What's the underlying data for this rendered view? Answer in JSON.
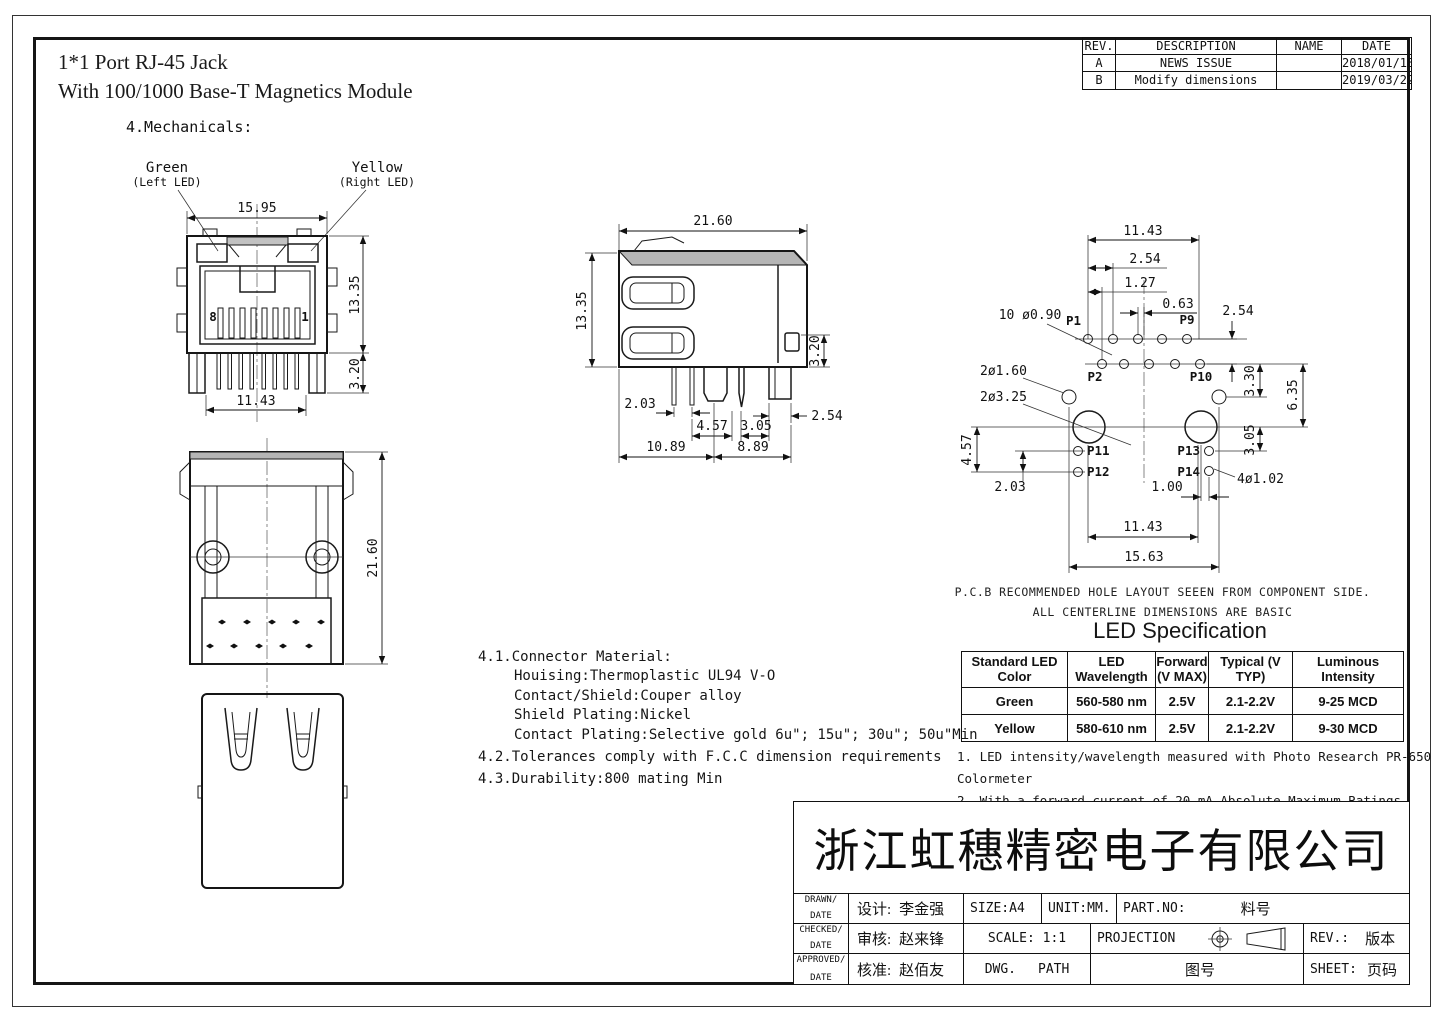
{
  "page": {
    "title_line1": "1*1 Port RJ-45  Jack",
    "title_line2": "With 100/1000 Base-T Magnetics Module"
  },
  "revision_table": {
    "headers": {
      "rev": "REV.",
      "description": "DESCRIPTION",
      "name": "NAME",
      "date": "DATE"
    },
    "rows": [
      {
        "rev": "A",
        "description": "NEWS ISSUE",
        "name": "",
        "date": "2018/01/18"
      },
      {
        "rev": "B",
        "description": "Modify dimensions",
        "name": "",
        "date": "2019/03/22"
      }
    ]
  },
  "mechanical": {
    "heading": "4.Mechanicals:",
    "led_left_label": "Green",
    "led_left_sub": "(Left LED)",
    "led_right_label": "Yellow",
    "led_right_sub": "(Right LED)"
  },
  "front_view": {
    "dim_width_top": "15.95",
    "dim_height_right": "13.35",
    "dim_pins_bottom": "11.43",
    "dim_leg_height": "3.20",
    "contact_num_left": "8",
    "contact_num_right": "1"
  },
  "side_view": {
    "dim_depth_top": "21.60",
    "dim_height_left": "13.35",
    "dim_tab_right": "3.20",
    "dim_pin_pitch": "2.03",
    "dim_pin_span": "4.57",
    "dim_post_gap": "3.05",
    "dim_block_width": "2.54",
    "dim_base_left": "10.89",
    "dim_base_right": "8.89"
  },
  "top_view": {
    "dim_length": "21.60"
  },
  "pcb_layout": {
    "dim_top_span": "11.43",
    "dim_pitch": "2.54",
    "dim_row_offset": "1.27",
    "dim_half_offset": "0.63",
    "dim_row_gap": "2.54",
    "dim_led_row": "3.30",
    "dim_post_row": "6.35",
    "dim_gnd_span": "4.57",
    "dim_gnd_gap": "2.03",
    "dim_post_gnd": "3.05",
    "dim_gnd_offset": "1.00",
    "dim_bottom_span": "11.43",
    "dim_total_span": "15.63",
    "callout_signal_holes": "10 ø0.90",
    "callout_led_holes": "2ø1.60",
    "callout_post_holes": "2ø3.25",
    "callout_gnd_holes": "4ø1.02",
    "pads": {
      "p1": "P1",
      "p2": "P2",
      "p9": "P9",
      "p10": "P10",
      "p11": "P11",
      "p12": "P12",
      "p13": "P13",
      "p14": "P14"
    },
    "caption1": "P.C.B RECOMMENDED HOLE LAYOUT SEEEN FROM COMPONENT SIDE.",
    "caption2": "ALL CENTERLINE DIMENSIONS ARE BASIC"
  },
  "material_notes": {
    "line1": "4.1.Connector Material:",
    "line2": "Houising:Thermoplastic UL94 V-O",
    "line3": "Contact/Shield:Couper alloy",
    "line4": "Shield Plating:Nickel",
    "line5": "Contact Plating:Selective gold 6u\"; 15u\"; 30u\"; 50u\"Min",
    "line6": "4.2.Tolerances comply with F.C.C dimension requirements",
    "line7": "4.3.Durability:800 mating Min"
  },
  "led_spec": {
    "title": "LED Specification",
    "headers": [
      "Standard LED Color",
      "LED Wavelength",
      "Forward\n(V MAX)",
      "Typical (V TYP)",
      "Luminous Intensity"
    ],
    "rows": [
      [
        "Green",
        "560-580 nm",
        "2.5V",
        "2.1-2.2V",
        "9-25 MCD"
      ],
      [
        "Yellow",
        "580-610 nm",
        "2.5V",
        "2.1-2.2V",
        "9-30 MCD"
      ]
    ],
    "note1": "1. LED intensity/wavelength measured with Photo Research PR-650 Colormeter",
    "note2": "2. With a forward current of 20 mA,Absolute Maximum Ratings (Ta=25℃)"
  },
  "title_block": {
    "company": "浙江虹穗精密电子有限公司",
    "drawn_label": "DRAWN/",
    "checked_label": "CHECKED/",
    "approved_label": "APPROVED/",
    "date_label": "DATE",
    "designer_label": "设计:",
    "designer_name": "李金强",
    "checker_label": "审核:",
    "checker_name": "赵来锋",
    "approver_label": "核准:",
    "approver_name": "赵佰友",
    "size": "SIZE:A4",
    "unit": "UNIT:MM.",
    "part_no_label": "PART.NO:",
    "part_no_value": "料号",
    "scale": "SCALE: 1:1",
    "projection_label": "PROJECTION",
    "rev_label": "REV.:",
    "rev_value": "版本",
    "dwg_label": "DWG.",
    "path_label": "PATH",
    "drawing_no": "图号",
    "sheet_label": "SHEET:",
    "sheet_value": "页码"
  }
}
